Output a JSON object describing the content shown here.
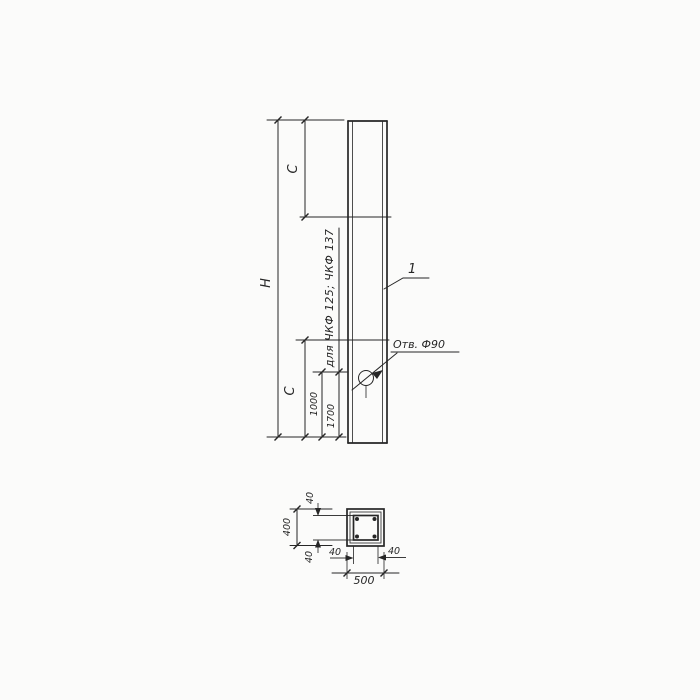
{
  "colors": {
    "ink": "#262626",
    "paper": "#fbfbfa"
  },
  "elevation": {
    "dim_h": "H",
    "dim_c_top": "C",
    "dim_c_bottom": "C",
    "dim_1000": "1000",
    "dim_1700": "1700",
    "note": "для ЧКФ 125; ЧКФ 137",
    "hole_label": "Отв. Ф90",
    "position_label": "1"
  },
  "section": {
    "dim_width": "500",
    "dim_height": "400",
    "cover_top": "40",
    "cover_bottom": "40",
    "cover_left": "40",
    "cover_right": "40"
  }
}
